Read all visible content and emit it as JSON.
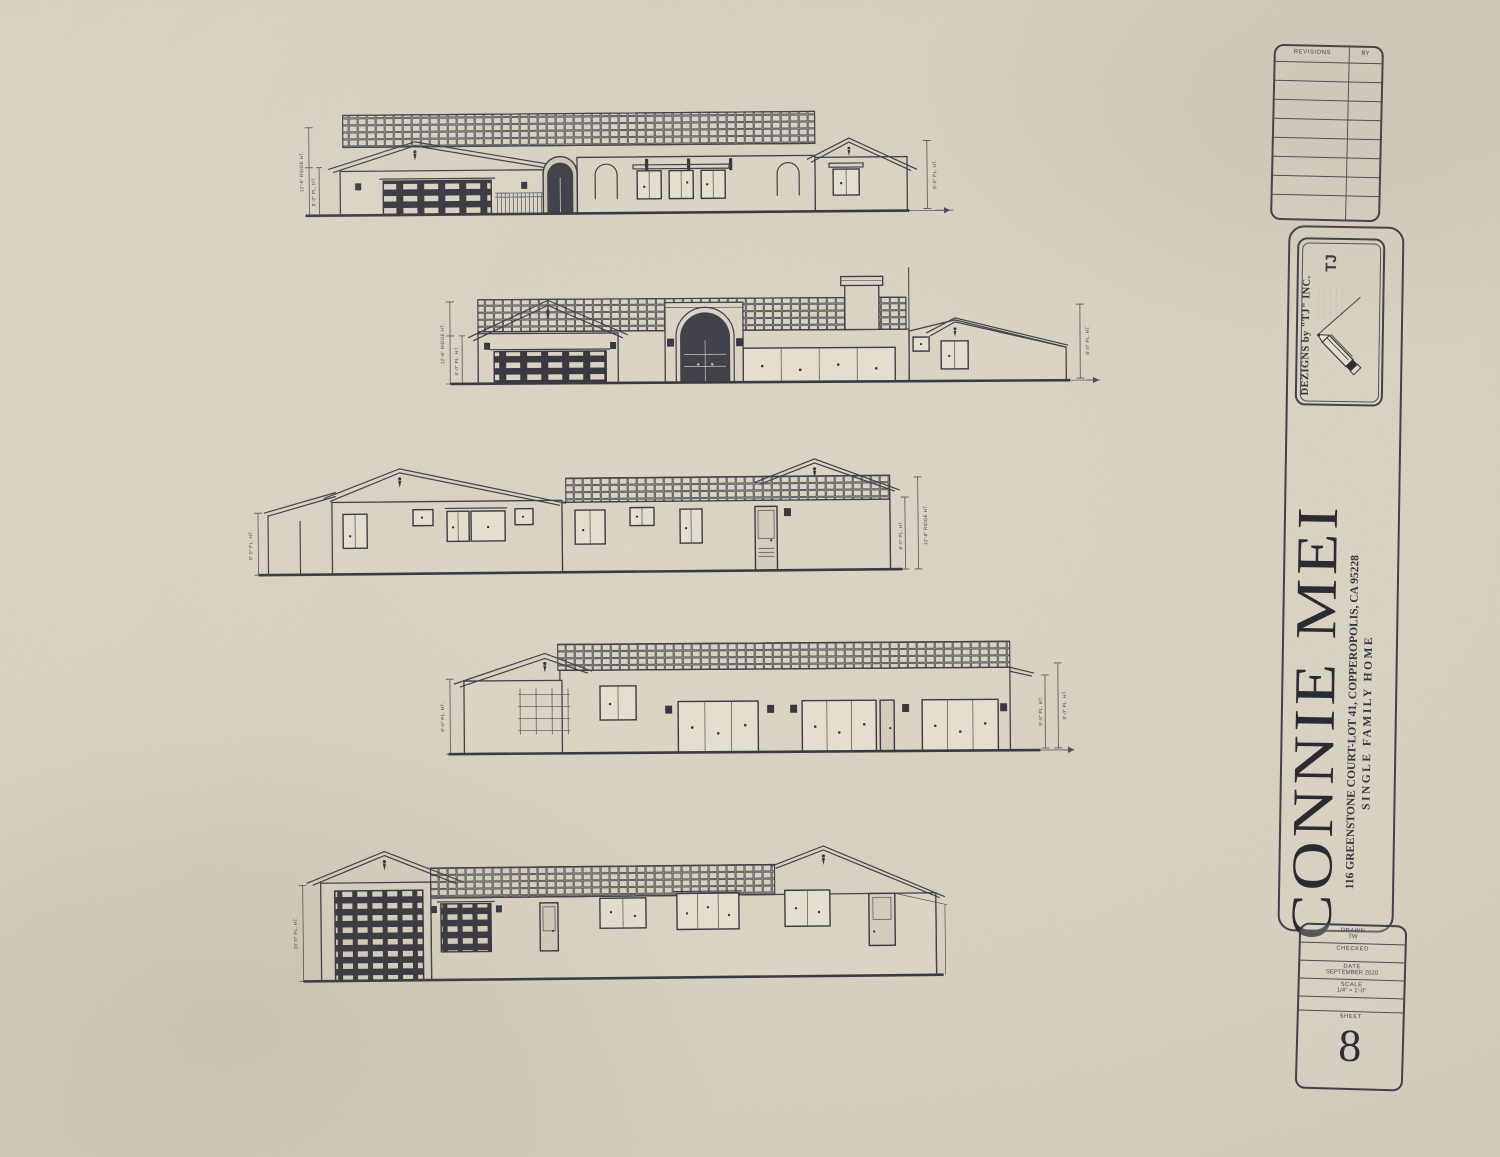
{
  "titleblock": {
    "revisions": {
      "col_item": "REVISIONS",
      "col_by": "BY"
    },
    "logo": {
      "icon": "pencil-icon",
      "company": "DEZIGNS by \"TJ\" INC.",
      "monogram": "TJ",
      "fineprint": [
        "··············",
        "··············",
        "··············",
        "··············",
        "··············"
      ]
    },
    "project": {
      "owner": "CONNIE MEI",
      "address": "116 GREENSTONE COURT-LOT 41, COPPEROPOLIS, CA 95228",
      "type": "SINGLE FAMILY HOME"
    },
    "info": {
      "rows": [
        {
          "label": "DRAWN",
          "value": "TW"
        },
        {
          "label": "CHECKED",
          "value": ""
        },
        {
          "label": "DATE",
          "value": "SEPTEMBER 2020"
        },
        {
          "label": "SCALE",
          "value": "1/4\" = 1'-0\""
        }
      ],
      "sheet_label": "SHEET",
      "sheet_number": "8"
    }
  },
  "elevations": [
    {
      "id": "elevation-1",
      "dims_left": [
        "12'-6\" RIDGE HT.",
        "8'-0\" PL. HT."
      ],
      "dims_right": [
        "9'-0\" PL. HT."
      ]
    },
    {
      "id": "elevation-2",
      "dims_left": [
        "12'-6\" RIDGE HT.",
        "9'-0\" PL. HT."
      ],
      "dims_right": [
        "8'-0\" PL. HT."
      ]
    },
    {
      "id": "elevation-3",
      "dims_left": [
        "8'-0\" PL. HT."
      ],
      "dims_right": [
        "8'-0\" PL. HT.",
        "12'-6\" RIDGE HT."
      ]
    },
    {
      "id": "elevation-4",
      "dims_left": [
        "8'-0\" PL. HT."
      ],
      "dims_right": [
        "9'-0\" PL. HT.",
        "8'-0\" PL. HT."
      ]
    },
    {
      "id": "elevation-5",
      "dims_left": [
        "10'-0\" PL. HT."
      ],
      "dims_right": []
    }
  ]
}
